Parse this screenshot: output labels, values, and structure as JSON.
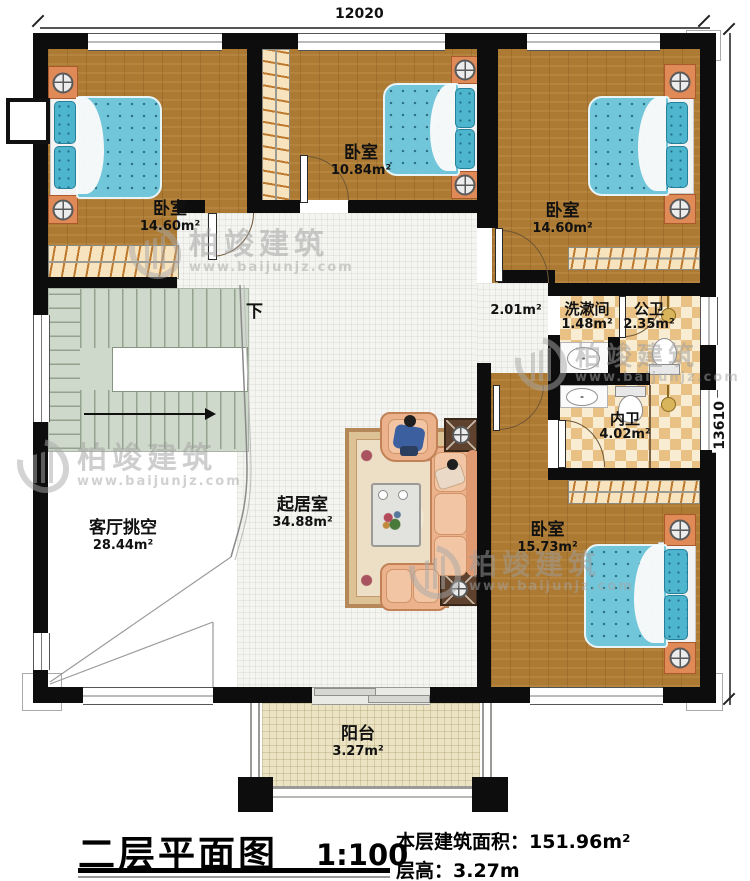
{
  "dimensions": {
    "top": "12020",
    "right": "13610"
  },
  "rooms": {
    "bedroom_tl": {
      "name": "卧室",
      "area": "14.60m²"
    },
    "bedroom_tm": {
      "name": "卧室",
      "area": "10.84m²"
    },
    "bedroom_tr": {
      "name": "卧室",
      "area": "14.60m²"
    },
    "bedroom_br": {
      "name": "卧室",
      "area": "15.73m²"
    },
    "living": {
      "name": "起居室",
      "area": "34.88m²"
    },
    "void": {
      "name": "客厅挑空",
      "area": "28.44m²"
    },
    "corridor": {
      "area": "2.01m²"
    },
    "washroom": {
      "name": "洗漱间",
      "area": "1.48m²"
    },
    "public_wc": {
      "name": "公卫",
      "area": "2.35m²"
    },
    "ensuite": {
      "name": "内卫",
      "area": "4.02m²"
    },
    "balcony": {
      "name": "阳台",
      "area": "3.27m²"
    },
    "stairs": {
      "direction_label": "下"
    }
  },
  "title_block": {
    "title": "二层平面图",
    "scale": "1:100",
    "floor_area_label": "本层建筑面积：",
    "floor_area_value": "151.96m²",
    "floor_height_label": "层高：",
    "floor_height_value": "3.27m"
  },
  "watermark": {
    "brand": "柏竣建筑",
    "url": "www.baijunjz.com"
  },
  "colors": {
    "wall": "#0d0d0d",
    "wood": "#ad7a33",
    "tile": "#f4f4f1",
    "checker_dark": "#e9c184",
    "checker_light": "#f8ecd2",
    "stairs": "#cfd9cb",
    "balcony": "#ece3c3",
    "bed": "#72c6da",
    "nightstand": "#e08a58"
  }
}
